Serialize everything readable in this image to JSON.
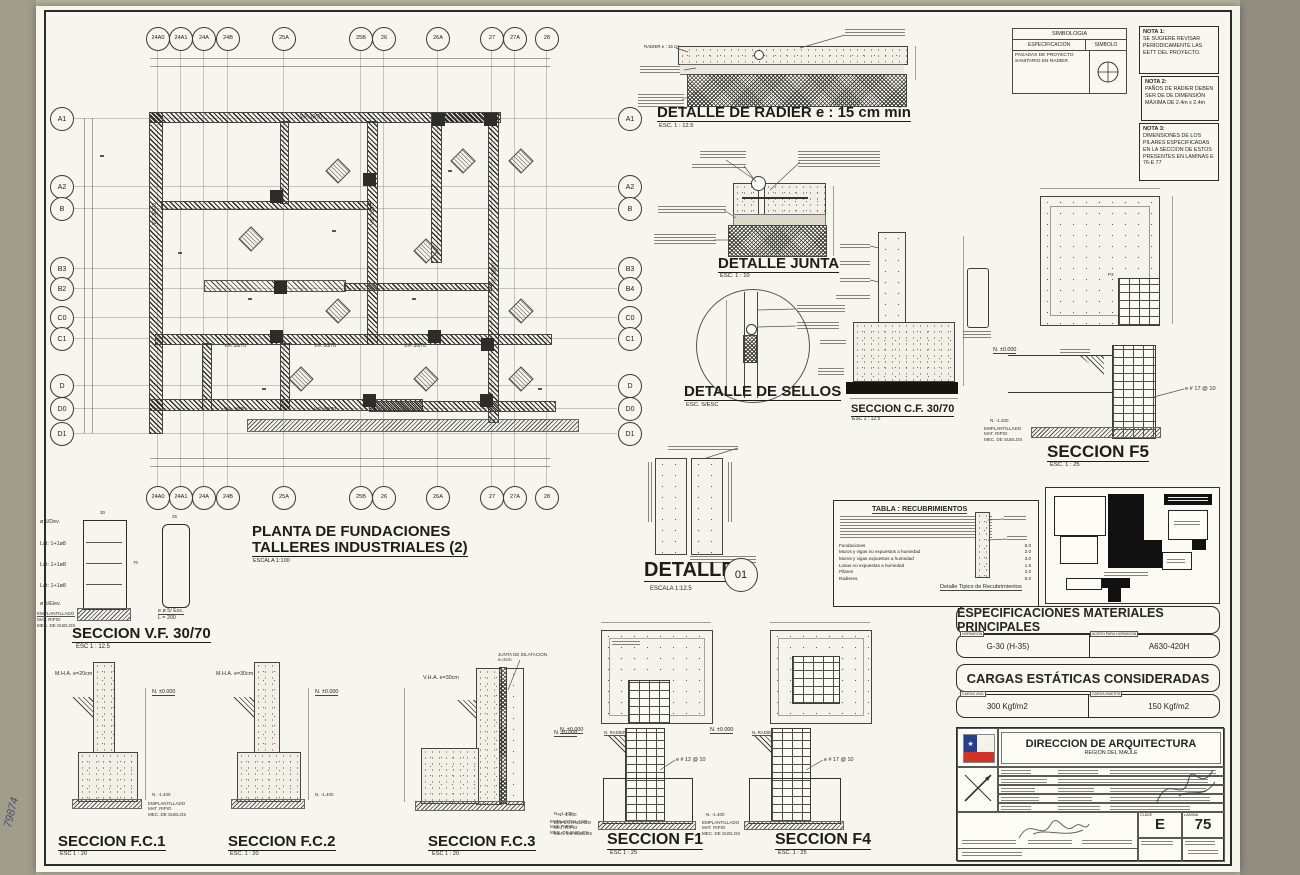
{
  "sheet": {
    "handwritten_number": "79874"
  },
  "common": {
    "nivel_superior": "N. ±0.000",
    "nivel_sello": "N. -1.400",
    "nivel_radier": "N. RADIER",
    "emplantillado": [
      "EMPLANTILLADO",
      "MAT. RIPIO",
      "MEC. DE SUELOS"
    ]
  },
  "plan": {
    "title_line1": "PLANTA DE FUNDACIONES",
    "title_line2": "TALLERES INDUSTRIALES (2)",
    "scale_label": "ESCALA  1:100",
    "col_bubbles": [
      "24A0",
      "24A1",
      "24A",
      "24B",
      "25A",
      "25B",
      "26",
      "26A",
      "27",
      "27A",
      "28"
    ],
    "row_bubbles_left": [
      "A1",
      "A2",
      "B",
      "B3",
      "B2",
      "C0",
      "C1",
      "D",
      "D0",
      "D1"
    ],
    "row_bubbles_right": [
      "A1",
      "A2",
      "B",
      "B3",
      "B4",
      "C0",
      "C1",
      "D",
      "D0",
      "D1"
    ],
    "wall_label": "V.F. 30/70",
    "level_tag": "N.-1.400"
  },
  "detalle_radier": {
    "title": "DETALLE  DE RADIER e : 15 cm min",
    "scale": "ESC.  1 : 12.5",
    "leader_label": "RADIER e : 15 cm"
  },
  "detalle_junta": {
    "title": "DETALLE JUNTA",
    "scale": "ESC.  1 : 10"
  },
  "detalle_sellos": {
    "title": "DETALLE DE SELLOS",
    "scale": "ESC.  S/ESC"
  },
  "seccion_cf": {
    "title": "SECCION C.F. 30/70",
    "scale": "ESC  1 : 12.5"
  },
  "seccion_f5": {
    "title": "SECCION  F5",
    "scale": "ESC. 1 : 25",
    "rebar_callout": "e # 17 @ 10",
    "tag": "P2"
  },
  "detalle_01": {
    "title": "DETALLE",
    "bubble": "01",
    "scale": "ESCALA 1:12.5"
  },
  "tabla_recubrimientos": {
    "title": "TABLA : RECUBRIMIENTOS",
    "rows": [
      {
        "label": "Fundaciones",
        "value": "5.0"
      },
      {
        "label": "Muros y vigas no expuestos a humedad",
        "value": "2.0"
      },
      {
        "label": "Muros y vigas expuestos a humedad",
        "value": "3.0"
      },
      {
        "label": "Losas no expuestas a humedad",
        "value": "1.5"
      },
      {
        "label": "Pilares",
        "value": "2.0"
      },
      {
        "label": "Radieres",
        "value": "5.0"
      }
    ],
    "caption": "Detalle Tipico de Recubrimientos"
  },
  "simbologia": {
    "title": "SIMBOLOGIA",
    "col_espec": "ESPECIFICACION",
    "col_simbolo": "SIMBOLO",
    "row_espec": "PASADAS DE PROYECTO SANITARIO EN RADIER"
  },
  "notas": [
    {
      "title": "NOTA 1:",
      "text": "SE SUGIERE REVISAR PERIODICAMENTE LAS EETT DEL PROYECTO."
    },
    {
      "title": "NOTA 2:",
      "text": "PAÑOS DE RADIER DEBEN SER DE DE DIMENSIÓN MÁXIMA DE 2.4m x 2.4m"
    },
    {
      "title": "NOTA 3:",
      "text": "DIMENSIONES DE LOS PILARES ESPECIFICADAS EN LA SECCION DE ESTOS PRESENTES EN LAMINAS E 76-E 77"
    }
  ],
  "especificaciones": {
    "title": "ESPECIFICACIONES MATERIALES PRINCIPALES",
    "hormigon_tab": "HORMIGON",
    "hormigon_value": "G-30 (H-35)",
    "acero_tab": "ACERO PARA HORMIGON",
    "acero_value": "A630-420H"
  },
  "cargas": {
    "title": "CARGAS ESTÁTICAS CONSIDERADAS",
    "viva_tab": "CARGA VIVA",
    "viva_value": "300 Kgf/m2",
    "muerta_tab": "CARGA MUERTA",
    "muerta_value": "150 Kgf/m2"
  },
  "titleblock": {
    "org": "DIRECCION DE ARQUITECTURA",
    "region": "REGION DEL MAULE",
    "clave_label": "CLAVE",
    "clave": "E",
    "lamina_label": "LAMINA",
    "lamina": "75"
  },
  "seccion_vf": {
    "title": "SECCION V.F. 30/70",
    "scale": "ESC   1 : 12.5",
    "labels": [
      "ø 5/Dev.",
      "Lat: 1+1ø8",
      "Lat: 1+1ø8",
      "Lat: 1+1ø8",
      "ø 5/Elev."
    ],
    "stirrup_label_1": "e ø 5/ Esc.",
    "stirrup_label_2": "L = 200",
    "dim_top": "30",
    "dim_side": "70",
    "dim_small": "25"
  },
  "seccion_fc1": {
    "title": "SECCION  F.C.1",
    "scale": "ESC 1 : 20",
    "wall_label": "M.H.A.  e=20cm"
  },
  "seccion_fc2": {
    "title": "SECCION  F.C.2",
    "scale": "ESC. 1 : 20",
    "wall_label": "M.H.A.  e=30cm"
  },
  "seccion_fc3": {
    "title": "SECCION  F.C.3",
    "scale": "ESC 1 : 20",
    "wall_label": "V.H.A.  e=30cm",
    "junta_label": "JUNTA DE DILATACION e=3cm"
  },
  "seccion_f1": {
    "title": "SECCION  F1",
    "scale": "ESC 1 : 25",
    "rebar_callout": "e # 12 @ 10"
  },
  "seccion_f4": {
    "title": "SECCION  F4",
    "scale": "ESC. 1 : 25",
    "rebar_callout": "e # 17 @ 10"
  }
}
